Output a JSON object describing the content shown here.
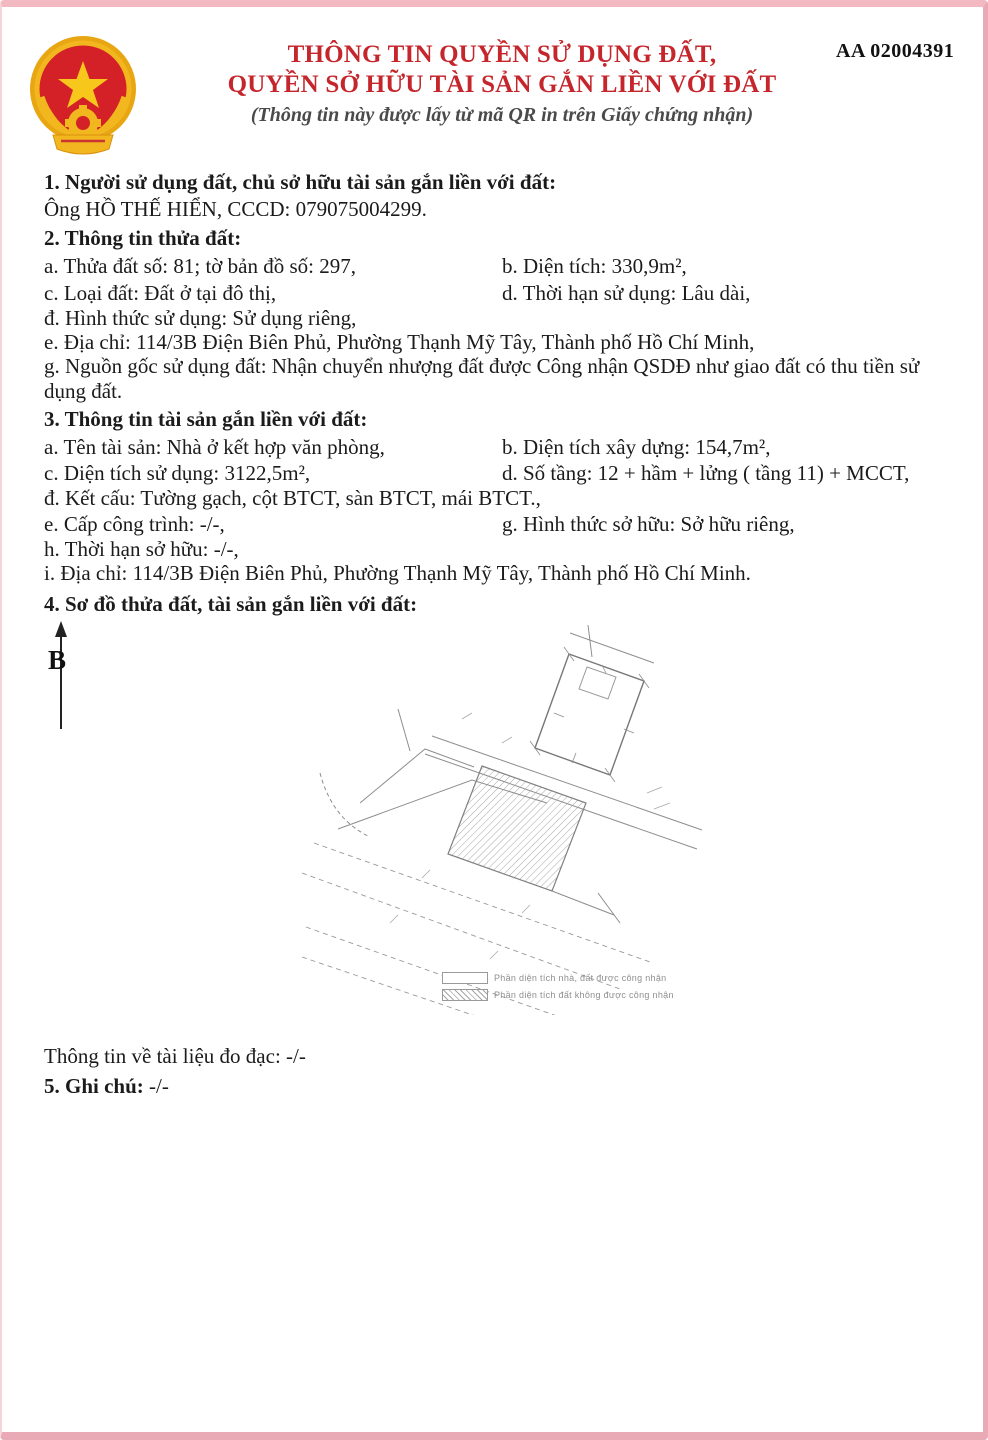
{
  "page": {
    "serial": "AA 02004391",
    "title_line1": "THÔNG TIN QUYỀN SỬ DỤNG ĐẤT,",
    "title_line2": "QUYỀN SỞ HỮU TÀI SẢN GẮN LIỀN VỚI ĐẤT",
    "subtitle": "(Thông tin này được lấy từ mã QR in trên Giấy chứng nhận)",
    "accent_color": "#c5262c",
    "border_color": "#e9aab5"
  },
  "section1": {
    "heading": "1. Người sử dụng đất, chủ sở hữu tài sản gắn liền với đất:",
    "owner": "Ông HỒ THẾ HIỂN, CCCD: 079075004299."
  },
  "section2": {
    "heading": "2. Thông tin thửa đất:",
    "items": {
      "a": "a. Thửa đất số: 81; tờ bản đồ số: 297,",
      "b": "b. Diện tích: 330,9m²,",
      "c": "c. Loại đất: Đất ở tại đô thị,",
      "d": "d. Thời hạn sử dụng: Lâu dài,",
      "dd": "đ. Hình thức sử dụng: Sử dụng riêng,",
      "e": "e. Địa chỉ: 114/3B Điện Biên Phủ, Phường Thạnh Mỹ Tây, Thành phố Hồ Chí Minh,",
      "g": "g. Nguồn gốc sử dụng đất: Nhận chuyển nhượng đất được Công nhận QSDĐ như giao đất có thu tiền sử dụng đất."
    }
  },
  "section3": {
    "heading": "3. Thông tin tài sản gắn liền với đất:",
    "items": {
      "a": "a. Tên tài sản: Nhà ở kết hợp văn phòng,",
      "b": "b. Diện tích xây dựng: 154,7m²,",
      "c": "c. Diện tích sử dụng: 3122,5m²,",
      "d": "d. Số tầng: 12 + hầm + lửng ( tầng 11) + MCCT,",
      "dd": "đ. Kết cấu: Tường gạch, cột BTCT, sàn BTCT, mái BTCT.,",
      "e": "e. Cấp công trình: -/-,",
      "g": "g. Hình thức sở hữu: Sở hữu riêng,",
      "h": "h. Thời hạn sở hữu: -/-,",
      "i": "i. Địa chỉ: 114/3B Điện Biên Phủ, Phường Thạnh Mỹ Tây, Thành phố Hồ Chí Minh."
    }
  },
  "section4": {
    "heading": "4. Sơ đồ thửa đất, tài sản gắn liền với đất:",
    "north_label": "B",
    "legend": {
      "recognized": "Phần diện tích nhà, đất được công nhận",
      "not_recognized": "Phần diện tích đất không được công nhận"
    }
  },
  "footer": {
    "measurement_doc": "Thông tin về tài liệu đo đạc: -/-",
    "note_label": "5. Ghi chú:",
    "note_value": "-/-"
  }
}
